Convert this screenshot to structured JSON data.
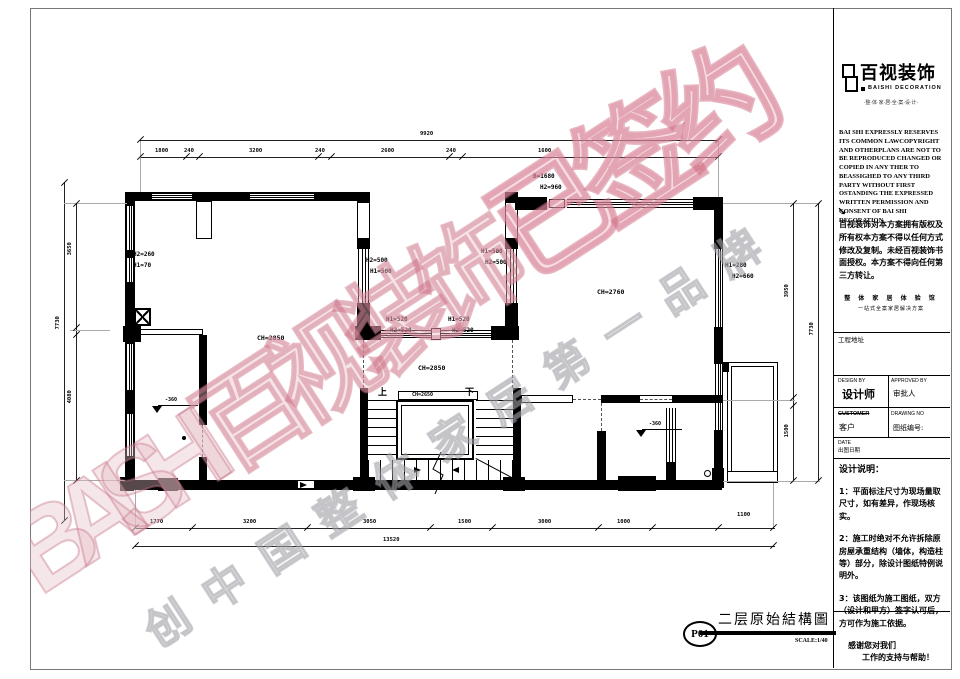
{
  "brand": {
    "name": "百视装饰",
    "name_en": "BAISHI DECORATION",
    "tagline": "·整·体·家·居·全·案·设·计·",
    "watermark_latin": "BAISHI",
    "watermark_cn": "百视装饰",
    "watermark_signed": "已签约",
    "watermark_slogan": "创中国整体家居第一品牌",
    "colors": {
      "watermark_pink": "#d98a9b",
      "watermark_gray": "#bdbdbd",
      "line": "#000000"
    }
  },
  "title_block": {
    "legal_en": "BAI SHI EXPRESSLY RESERVES ITS COMMON LAWCOPYRIGHT AND OTHERPLANS ARE NOT TO BE REPRODUCED CHANGED OR COPIED IN ANY THER TO BEASSIGHED TO ANY THIRD PARTY WITHOUT FIRST OSTANDING THE EXPRESSED WRITTEN PERMISSION AND CONSENT OF BAI SHI DECORATION",
    "arrow": "↘",
    "legal_cn": "百视装饰对本方案拥有版权及所有权本方案不得以任何方式修改及复制。未经百视装饰书面授权。本方案不得向任何第三方转让。",
    "slogan1": "整 体 家 居 体 验 馆",
    "slogan2": "一站式全案家居解决方案",
    "project_address_label": "工程地址",
    "design_by_label": "DESIGN BY",
    "designer": "设计师",
    "approved_by_label": "APPROVED BY",
    "approver": "审批人",
    "customer_label": "CUSTOMER",
    "customer_cn": "客户",
    "drawing_no_label": "DRAWING NO",
    "drawing_no_cn": "图纸编号:",
    "date_label": "DATE",
    "date_cn": "出图日期",
    "notes_title": "设计说明：",
    "notes": [
      "1：平面标注尺寸为现场量取尺寸，如有差异，作现场核实。",
      "2：施工时绝对不允许拆除原房屋承重结构（墙体，构造柱等）部分，除设计图纸特例说明外。",
      "3：该图纸为施工图纸，双方（设计和甲方）签字认可后，方可作为施工依据。"
    ],
    "thanks1": "感谢您对我们",
    "thanks2": "工作的支持与帮助！"
  },
  "sheet": {
    "number": "P01",
    "title": "二层原始結構圖",
    "scale": "SCALE:1/40"
  },
  "plan": {
    "room_labels": {
      "left": "CH=2850",
      "middle": "CH=2850",
      "stair": "CH=2650",
      "right": "CH=2760"
    },
    "opening_labels": {
      "left_wall_1": "H2=260",
      "left_wall_2": "H1=70",
      "mid_left_1": "H2=500",
      "mid_left_2": "H1=500",
      "mid_right_1": "H1=500",
      "mid_right_2": "H2=500",
      "band_left_1": "H1=520",
      "band_left_2": "H2=520",
      "band_right_1": "H1=520",
      "band_right_2": "H2=520",
      "right_wall_1": "H1=280",
      "right_wall_2": "H2=660",
      "top_right_1": "B=1680",
      "top_right_2": "H2=960"
    },
    "levels": {
      "left": "-360",
      "right": "-360"
    },
    "stair": {
      "up": "上",
      "down": "下"
    },
    "dims": {
      "top": {
        "total": "9920",
        "segments": [
          "1800",
          "240",
          "3200",
          "240",
          "2600",
          "240",
          "1600"
        ]
      },
      "bottom": {
        "total": "13520",
        "segments": [
          "1770",
          "3200",
          "3050",
          "1500",
          "3000",
          "1000",
          "1100"
        ]
      },
      "left": {
        "total": "7730",
        "segments": [
          "3650",
          "4080"
        ]
      },
      "right": {
        "total": "7730",
        "segments": [
          "3950",
          "1500"
        ]
      }
    }
  }
}
